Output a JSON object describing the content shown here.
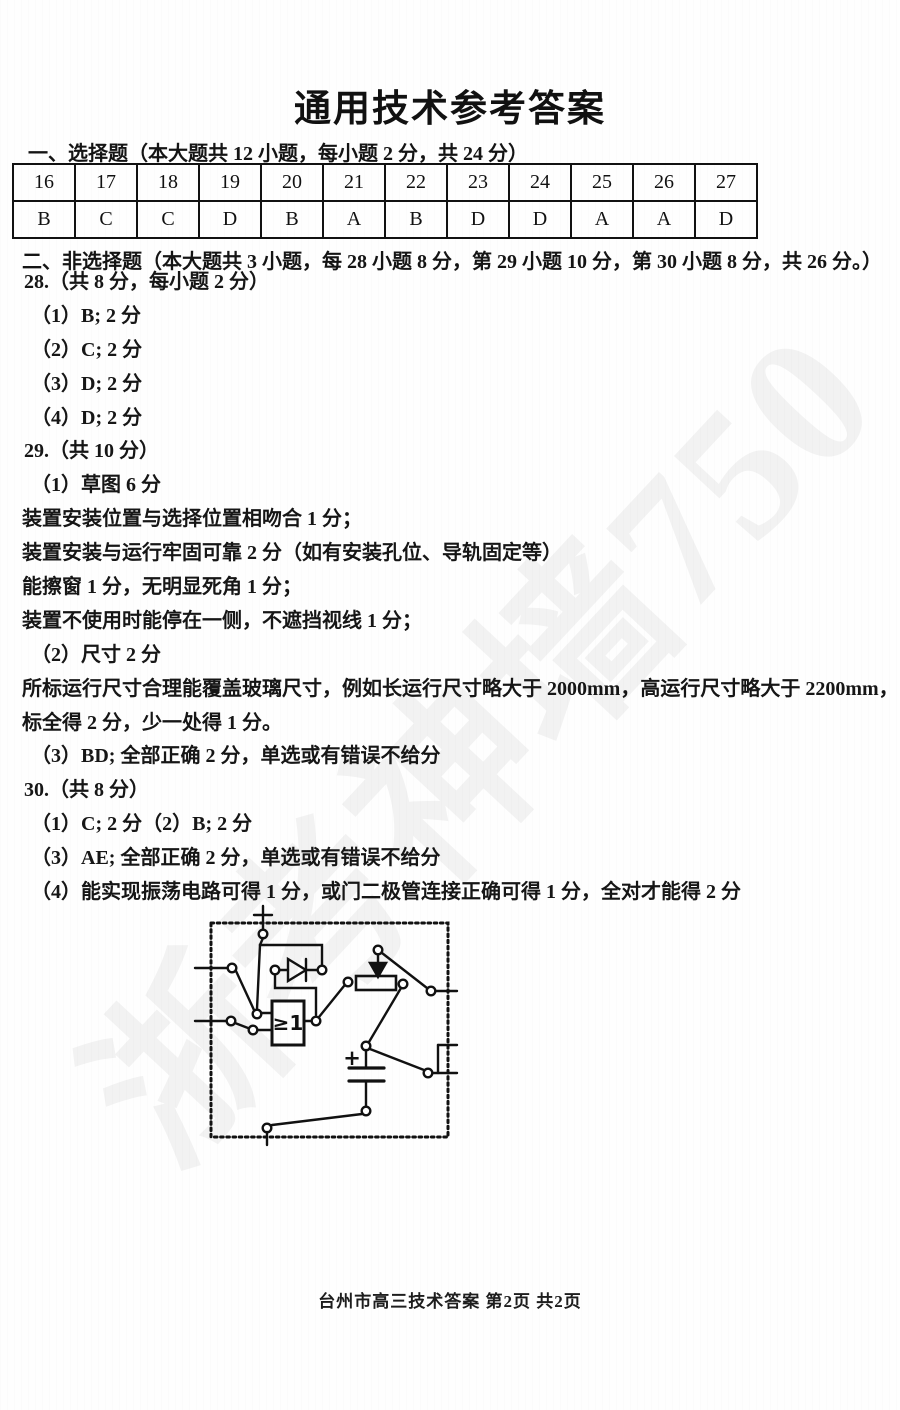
{
  "page": {
    "title": "通用技术参考答案",
    "footer": "台州市高三技术答案 第2页 共2页",
    "watermark": "浙考神墙750"
  },
  "section1": {
    "heading": "一、选择题（本大题共 12 小题，每小题 2 分，共 24 分）",
    "table": {
      "numbers": [
        "16",
        "17",
        "18",
        "19",
        "20",
        "21",
        "22",
        "23",
        "24",
        "25",
        "26",
        "27"
      ],
      "answers": [
        "B",
        "C",
        "C",
        "D",
        "B",
        "A",
        "B",
        "D",
        "D",
        "A",
        "A",
        "D"
      ]
    }
  },
  "section2": {
    "heading": "二、非选择题（本大题共 3 小题，每 28 小题 8 分，第 29 小题 10 分，第 30 小题 8 分，共 26 分。）",
    "lines": [
      "28.（共 8 分，每小题 2 分）",
      "（1）B; 2 分",
      "（2）C; 2 分",
      "（3）D; 2 分",
      "（4）D; 2 分",
      "29.（共 10 分）",
      "（1）草图 6 分",
      "装置安装位置与选择位置相吻合 1 分；",
      "装置安装与运行牢固可靠 2 分（如有安装孔位、导轨固定等）",
      "能擦窗 1 分，无明显死角 1 分；",
      "装置不使用时能停在一侧，不遮挡视线 1 分；",
      "（2）尺寸 2 分",
      "所标运行尺寸合理能覆盖玻璃尺寸，例如长运行尺寸略大于 2000mm，高运行尺寸略大于 2200mm，",
      "标全得 2 分，少一处得 1 分。",
      "（3）BD; 全部正确 2 分，单选或有错误不给分",
      "30.（共 8 分）",
      "（1）C; 2 分（2）B; 2 分",
      "（3）AE; 全部正确 2 分，单选或有错误不给分",
      "（4）能实现振荡电路可得 1 分，或门二极管连接正确可得 1 分，全对才能得 2 分"
    ]
  },
  "circuit": {
    "or_gate_label": "≥1",
    "capacitor_plus_label": "+"
  },
  "colors": {
    "ink": "#111111",
    "watermark": "rgba(40,40,40,0.055)"
  }
}
